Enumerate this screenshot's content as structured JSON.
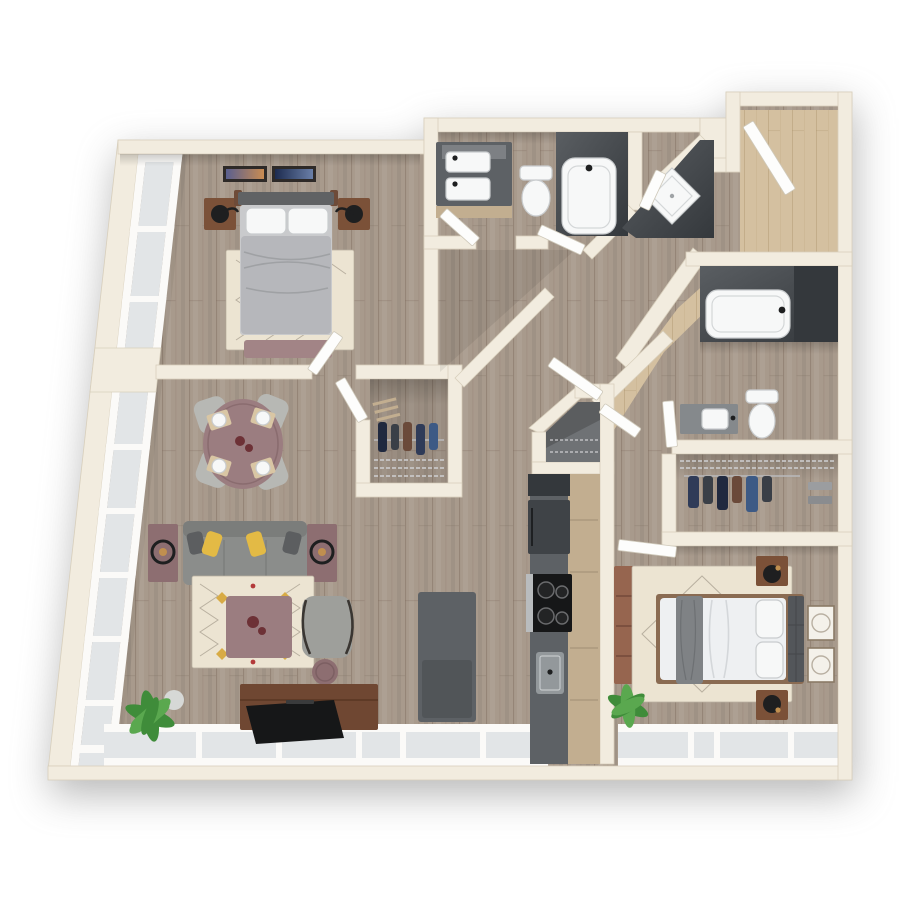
{
  "colors": {
    "bg": "#ffffff",
    "wall": "#f2ecdf",
    "wallEdge": "#d8cfbc",
    "floor": "#a89a8c",
    "entryFloor": "#d4c0a0",
    "glass": "#e2e5e7",
    "frame": "#fbfaf8",
    "door": "#fdfdfc",
    "tileDark": "#4b4f54",
    "tileDarker": "#34383c",
    "counter": "#5d6165",
    "cabinet": "#c2ae90",
    "fixture": "#f7f8f8",
    "fixtureEdge": "#c9ccce",
    "island": "#5d6165",
    "sofa": "#8b8d8b",
    "sofaBack": "#7b7d7b",
    "pillowYellow": "#e3ba45",
    "pillowDark": "#5c5e60",
    "mauve": "#9b7d80",
    "mauveDeep": "#8d6e71",
    "rug": "#ece4d2",
    "rugLine": "#b9b0a0",
    "walnut": "#7b5138",
    "tvWood": "#6f4732",
    "tvBlack": "#161718",
    "headboard1": "#606264",
    "duvet": "#b6b7bb",
    "headboard2": "#53565a",
    "mattress": "#eef0f2",
    "throwGray": "#7f8285",
    "plant": "#3f8c3a",
    "plantLight": "#5aa84f",
    "dresser": "#96654f",
    "accentRed": "#6d3136",
    "clothA": "#2f3b58",
    "clothB": "#3a3f47",
    "clothC": "#6b4a3a",
    "clothD": "#3d5a85",
    "clothE": "#20293f",
    "brass": "#c08f4f",
    "black": "#1e1f20"
  },
  "scene": {
    "view": "top-down 3D floor plan render",
    "layout": "2 bedroom / 2 bathroom apartment with open living-dining and galley kitchen",
    "rooms": [
      {
        "id": "bedroom-1",
        "furniture": [
          "queen-bed",
          "headboard",
          "white-pillows",
          "gray-duvet",
          "foot-bench",
          "nightstand-left",
          "nightstand-right",
          "table-lamp-left",
          "table-lamp-right",
          "area-rug",
          "wall-art-1",
          "wall-art-2"
        ]
      },
      {
        "id": "walk-in-closet",
        "furniture": [
          "hanging-clothes",
          "wire-shelving",
          "shoe-rack"
        ]
      },
      {
        "id": "bathroom-1",
        "furniture": [
          "double-vanity",
          "vanity-mirror",
          "two-sinks",
          "toilet",
          "tub-shower"
        ]
      },
      {
        "id": "shower-room",
        "furniture": [
          "corner-shower-pan"
        ]
      },
      {
        "id": "entry",
        "furniture": [
          "entry-door"
        ]
      },
      {
        "id": "hallway",
        "furniture": [
          "interior-doors"
        ]
      },
      {
        "id": "living-dining",
        "furniture": [
          "round-dining-table",
          "dining-chairs-x4",
          "place-settings-x4",
          "sofa",
          "yellow-throw-pillows",
          "side-table-left",
          "side-table-right",
          "table-lamps",
          "coffee-table",
          "accent-chair",
          "round-stool",
          "area-rug",
          "tv-console",
          "flat-tv",
          "floor-plant",
          "vase"
        ]
      },
      {
        "id": "kitchen",
        "furniture": [
          "island",
          "refrigerator",
          "range",
          "kitchen-sink",
          "upper-cabinet",
          "base-cabinets",
          "pantry-closet"
        ]
      },
      {
        "id": "bathroom-2",
        "furniture": [
          "tub-shower",
          "toilet",
          "vanity",
          "sink"
        ]
      },
      {
        "id": "closet-2",
        "furniture": [
          "hanging-clothes",
          "wire-shelving"
        ]
      },
      {
        "id": "bedroom-2",
        "furniture": [
          "queen-bed",
          "tufted-headboard",
          "white-pillows",
          "gray-throw",
          "nightstand-top",
          "nightstand-bottom",
          "table-lamps",
          "dresser",
          "area-rug",
          "wall-art-x2",
          "floor-plant"
        ]
      },
      {
        "id": "window-walls",
        "furniture": [
          "left-window-wall",
          "bottom-window-wall"
        ]
      }
    ]
  }
}
